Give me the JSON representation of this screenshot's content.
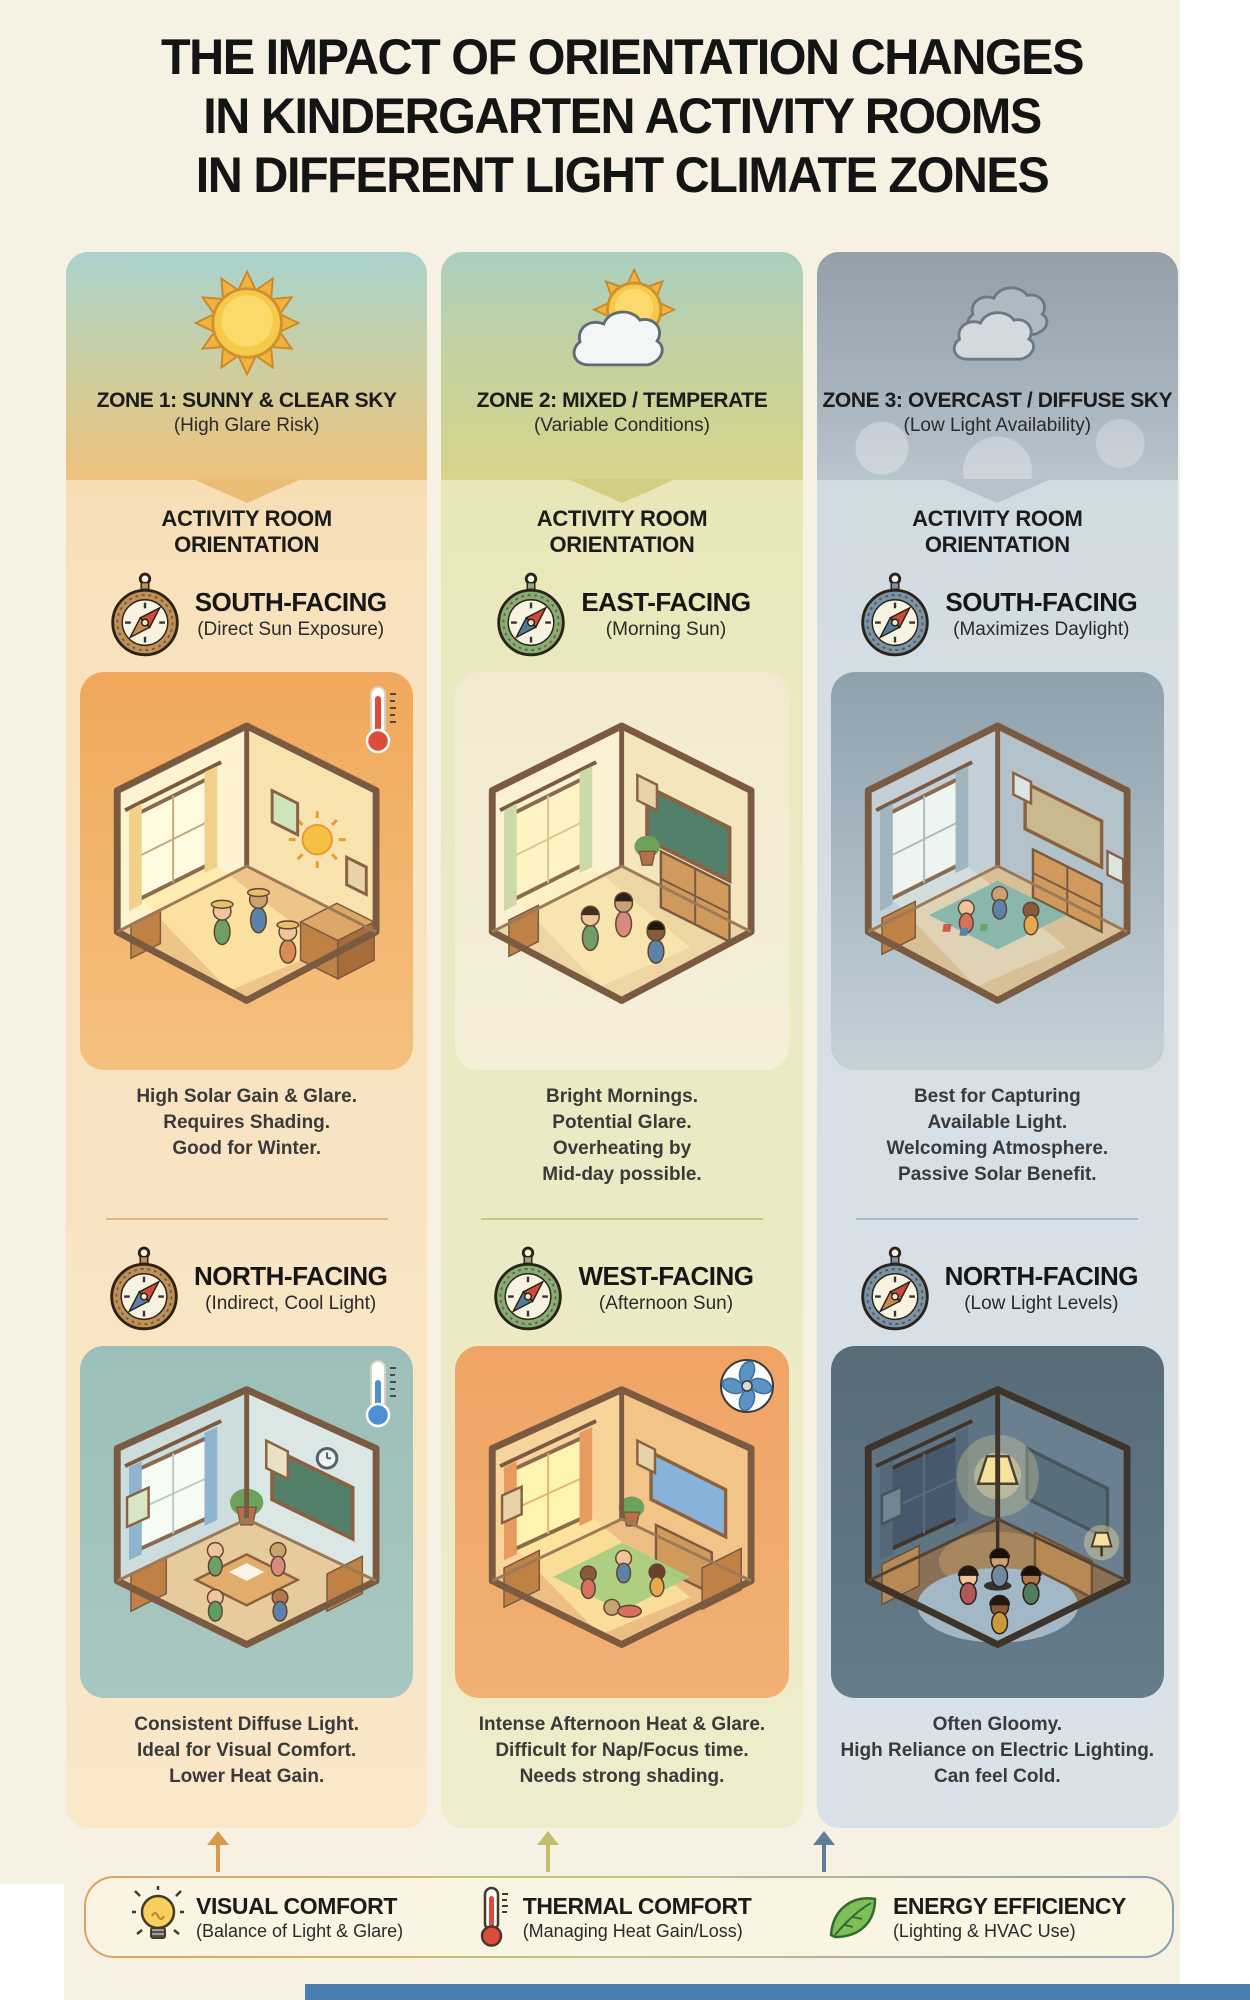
{
  "title_lines": [
    "THE IMPACT OF ORIENTATION CHANGES",
    "IN KINDERGARTEN ACTIVITY ROOMS",
    "IN DIFFERENT LIGHT CLIMATE ZONES"
  ],
  "zones": [
    {
      "zone_title": "ZONE 1: SUNNY & CLEAR SKY",
      "zone_subtitle": "(High Glare Risk)",
      "weather_icon": "sun-icon",
      "section_header_line1": "ACTIVITY ROOM",
      "section_header_line2": "ORIENTATION",
      "orientations": [
        {
          "heading": "SOUTH-FACING",
          "subheading": "(Direct Sun Exposure)",
          "badge_icon": "thermometer-hot-icon",
          "description_lines": [
            "High Solar Gain & Glare.",
            "Requires Shading.",
            "Good for Winter."
          ]
        },
        {
          "heading": "NORTH-FACING",
          "subheading": "(Indirect, Cool Light)",
          "badge_icon": "thermometer-cold-icon",
          "description_lines": [
            "Consistent Diffuse Light.",
            "Ideal for Visual Comfort.",
            "Lower Heat Gain."
          ]
        }
      ]
    },
    {
      "zone_title": "ZONE 2: MIXED / TEMPERATE",
      "zone_subtitle": "(Variable Conditions)",
      "weather_icon": "sun-cloud-icon",
      "section_header_line1": "ACTIVITY ROOM",
      "section_header_line2": "ORIENTATION",
      "orientations": [
        {
          "heading": "EAST-FACING",
          "subheading": "(Morning Sun)",
          "badge_icon": "",
          "description_lines": [
            "Bright Mornings.",
            "Potential Glare.",
            "Overheating by",
            "Mid-day possible."
          ]
        },
        {
          "heading": "WEST-FACING",
          "subheading": "(Afternoon Sun)",
          "badge_icon": "fan-icon",
          "description_lines": [
            "Intense Afternoon Heat & Glare.",
            "Difficult for Nap/Focus time.",
            "Needs strong shading."
          ]
        }
      ]
    },
    {
      "zone_title": "ZONE 3: OVERCAST / DIFFUSE SKY",
      "zone_subtitle": "(Low Light Availability)",
      "weather_icon": "clouds-icon",
      "section_header_line1": "ACTIVITY ROOM",
      "section_header_line2": "ORIENTATION",
      "orientations": [
        {
          "heading": "SOUTH-FACING",
          "subheading": "(Maximizes Daylight)",
          "badge_icon": "",
          "description_lines": [
            "Best for Capturing",
            "Available Light.",
            "Welcoming Atmosphere.",
            "Passive Solar Benefit."
          ]
        },
        {
          "heading": "NORTH-FACING",
          "subheading": "(Low Light Levels)",
          "badge_icon": "",
          "description_lines": [
            "Often Gloomy.",
            "High Reliance on Electric Lighting.",
            "Can feel Cold."
          ]
        }
      ]
    }
  ],
  "legend": {
    "items": [
      {
        "icon": "lightbulb-icon",
        "label": "VISUAL COMFORT",
        "sublabel": "(Balance of Light & Glare)"
      },
      {
        "icon": "thermometer-icon",
        "label": "THERMAL COMFORT",
        "sublabel": "(Managing Heat Gain/Loss)"
      },
      {
        "icon": "leaf-icon",
        "label": "ENERGY EFFICIENCY",
        "sublabel": "(Lighting & HVAC Use)"
      }
    ]
  },
  "colors": {
    "zone1_sky_top": "#a9d3cf",
    "zone1_sky_bottom": "#eec27c",
    "zone2_sky_top": "#aacfbf",
    "zone2_sky_bottom": "#d8d48a",
    "zone3_sky_top": "#939fa9",
    "zone3_sky_bottom": "#b9c5cd",
    "legend_arrow_1": "#d99a4e",
    "legend_arrow_2": "#c2bd68",
    "legend_arrow_3": "#5f7d99",
    "bottom_bar": "#4a7db2"
  }
}
